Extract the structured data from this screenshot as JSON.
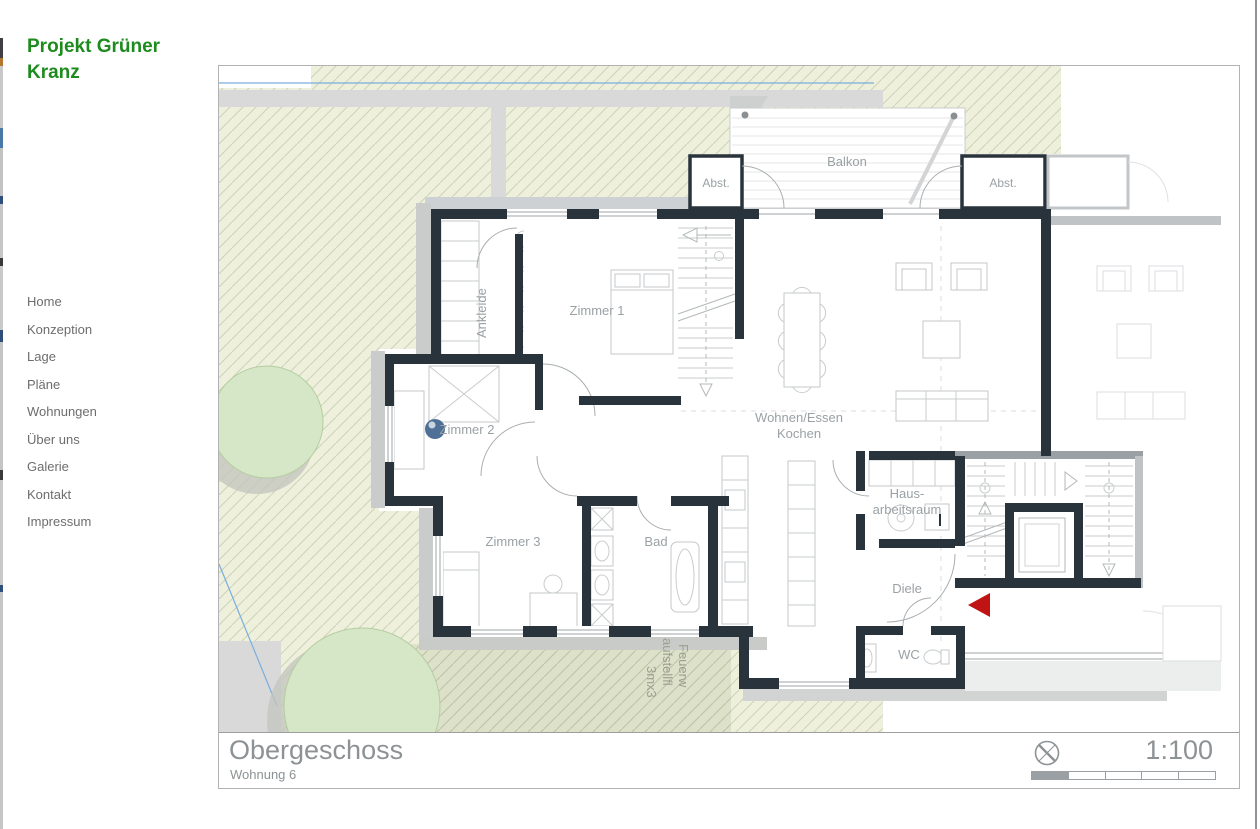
{
  "brand": {
    "title_line1": "Projekt Grüner",
    "title_line2": "Kranz",
    "color": "#1e8b1e"
  },
  "nav": {
    "items": [
      {
        "label": "Home"
      },
      {
        "label": "Konzeption"
      },
      {
        "label": "Lage"
      },
      {
        "label": "Pläne"
      },
      {
        "label": "Wohnungen"
      },
      {
        "label": "Über uns"
      },
      {
        "label": "Galerie"
      },
      {
        "label": "Kontakt"
      },
      {
        "label": "Impressum"
      }
    ]
  },
  "plan": {
    "floor_title": "Obergeschoss",
    "unit_subtitle": "Wohnung 6",
    "scale_label": "1:100",
    "labels": {
      "balkon": "Balkon",
      "abst_left": "Abst.",
      "abst_right": "Abst.",
      "ankleide": "Ankleide",
      "zimmer1": "Zimmer 1",
      "zimmer2": "Zimmer 2",
      "zimmer3": "Zimmer 3",
      "bad": "Bad",
      "wohnen_line1": "Wohnen/Essen",
      "wohnen_line2": "Kochen",
      "haus_line1": "Haus-",
      "haus_line2": "arbeitsraum",
      "diele": "Diele",
      "wc": "WC",
      "feuer_line1": "Feuerw",
      "feuer_line2": "aufstellfl",
      "feuer_line3": "3mx3"
    },
    "colors": {
      "wall": "#28333b",
      "garden_light": "#eef0dc",
      "garden_dark": "#dde1ca",
      "tree": "#d5e7c7",
      "path_gray": "#d9d9d9",
      "entry_arrow_red": "#c01414",
      "boundary_blue": "#79aede"
    }
  }
}
